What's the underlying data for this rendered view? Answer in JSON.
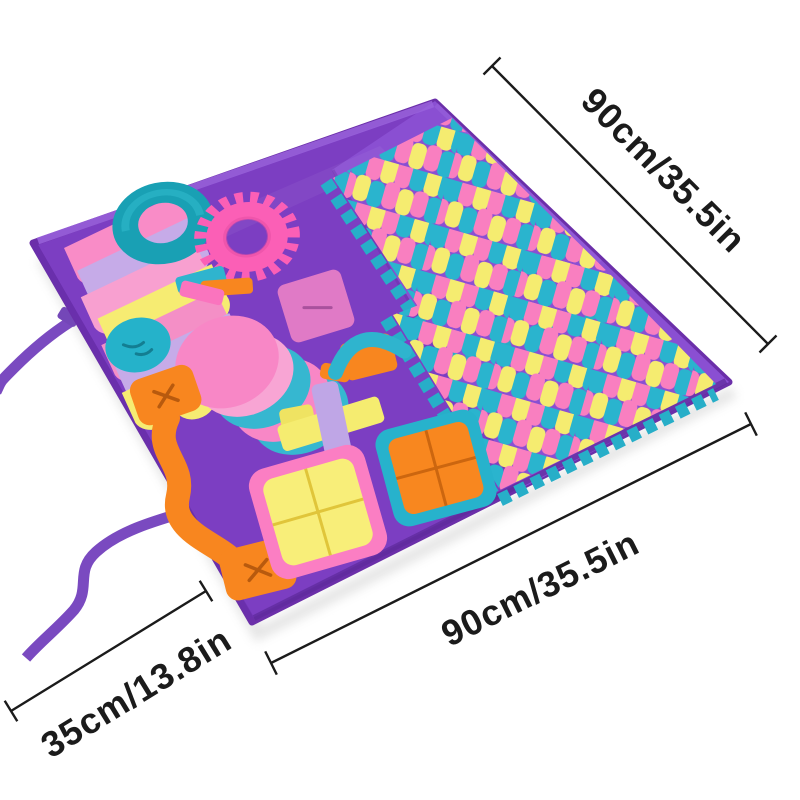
{
  "annotations": {
    "top_right_label": "90cm/35.5in",
    "bottom_label": "90cm/35.5in",
    "left_label": "35cm/13.8in"
  },
  "palette": {
    "background": "#ffffff",
    "dimension_ink": "#1b1b1b",
    "mat_purple": "#7c3ec2",
    "mat_purple_light": "#8a4fd2",
    "mat_hem_dark": "#6b2fa9",
    "mat_hem_light": "#9a63dd",
    "strap_purple": "#7a4ac0",
    "fringe_pink": "#f97fc0",
    "fringe_yellow": "#f5ec70",
    "fringe_teal": "#2ab4ce",
    "teal_ring": "#19a0b4",
    "hot_pink": "#fb5fb6",
    "orange": "#f8861f",
    "orange_slit": "#b85a0e",
    "lavender": "#bfa6e6",
    "orchid_pink": "#e07ac6",
    "scallop_pink": "#f98cc7",
    "pocket_pink": "#fb7ec3",
    "pocket_yellow": "#f8ee79",
    "pocket_teal": "#27b2cc"
  }
}
